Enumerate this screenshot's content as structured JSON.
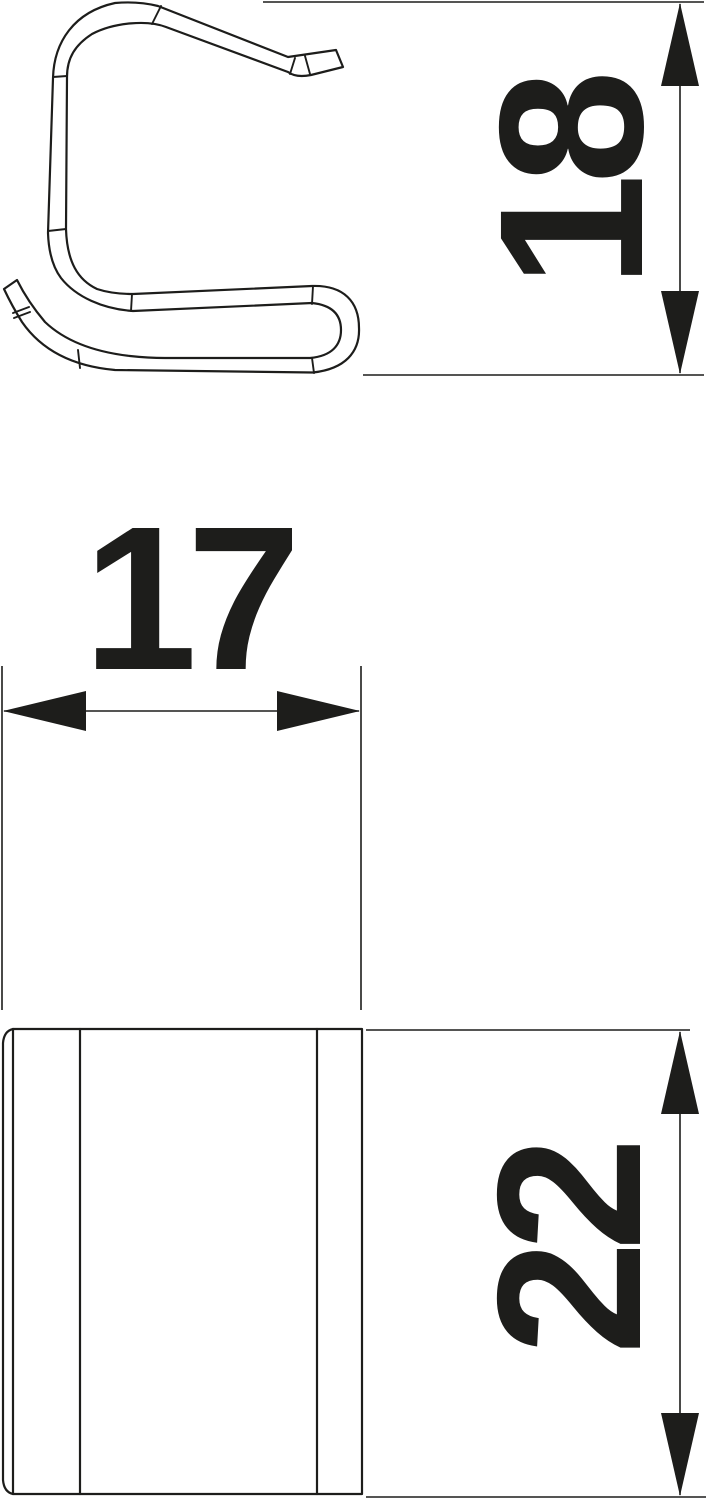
{
  "drawing": {
    "background_color": "#ffffff",
    "line_color": "#1d1d1b",
    "views": {
      "side_view": "clip side profile",
      "front_view": "clip front face"
    },
    "dimensions": {
      "side_height": {
        "value": "18",
        "orientation": "vertical",
        "text_rotation": "reads-bottom-to-top"
      },
      "front_width": {
        "value": "17",
        "orientation": "horizontal",
        "text_rotation": "none"
      },
      "front_height": {
        "value": "22",
        "orientation": "vertical",
        "text_rotation": "reads-bottom-to-top"
      }
    }
  }
}
